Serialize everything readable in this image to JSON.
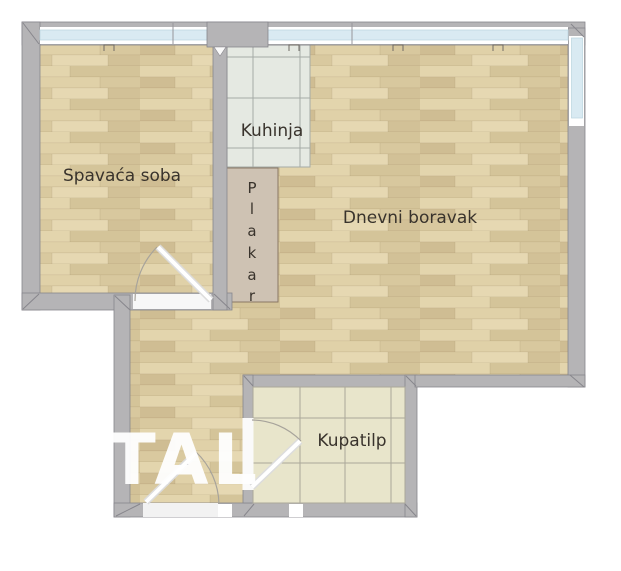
{
  "plan": {
    "rooms": {
      "bedroom": {
        "label": "Spavaća soba"
      },
      "kitchen": {
        "label": "Kuhinja"
      },
      "living_room": {
        "label": "Dnevni boravak"
      },
      "bathroom": {
        "label": "Kupatilp"
      },
      "closet": {
        "label": "Plakar",
        "letters": [
          "P",
          "l",
          "a",
          "k",
          "a",
          "r"
        ]
      }
    },
    "watermark": {
      "text": "TAL"
    },
    "colors": {
      "background": "#ffffff",
      "wall": "#b5b4b6",
      "wall_outline": "#87868c",
      "window_glass": "#d9eaf2",
      "wood_floor": "#dccca2",
      "kitchen_tile": "#e5e9e2",
      "bathroom_tile": "#e8e5cb",
      "closet_fill": "#cec2b3",
      "closet_border": "#8a7864",
      "door_leaf": "#ffffff",
      "label_text": "#39332c",
      "watermark": "#ffffff"
    }
  }
}
